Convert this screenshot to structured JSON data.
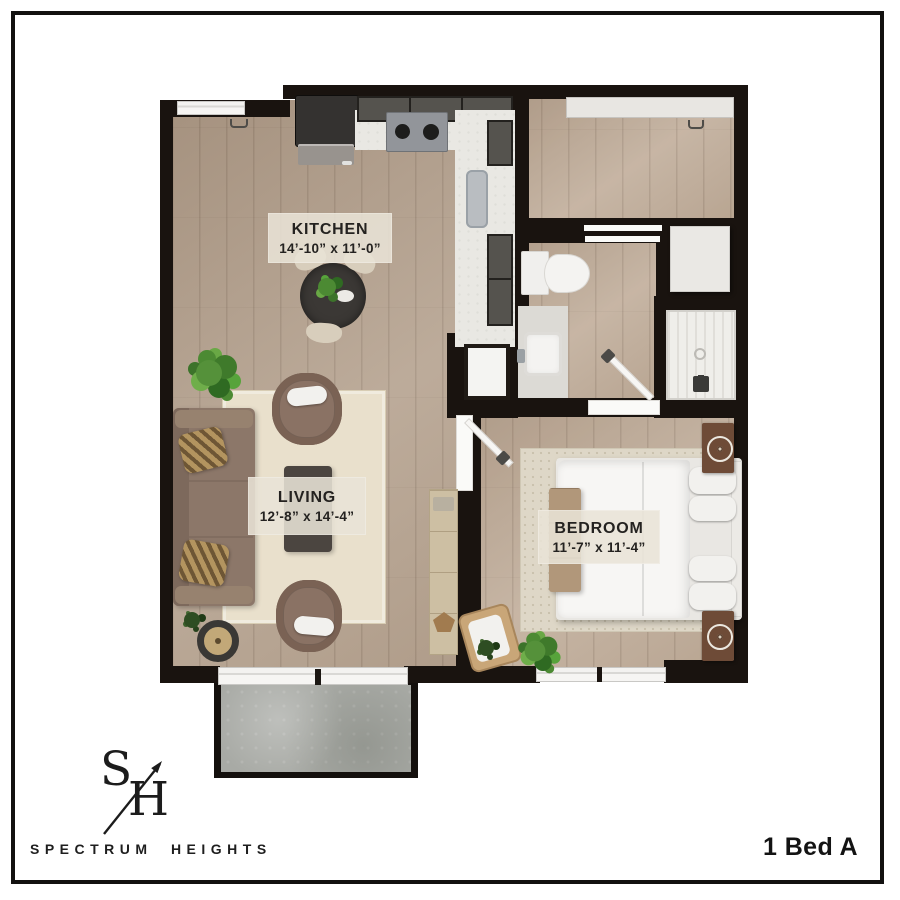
{
  "branding": {
    "monogram": {
      "letter_s": "S",
      "letter_h": "H"
    },
    "company_name": "SPECTRUM HEIGHTS"
  },
  "plan": {
    "unit_label": "1 Bed A",
    "rooms": [
      {
        "name": "KITCHEN",
        "dimensions": "14’-10” x 11’-0”"
      },
      {
        "name": "LIVING",
        "dimensions": "12’-8” x 14’-4”"
      },
      {
        "name": "BEDROOM",
        "dimensions": "11’-7” x 11’-4”"
      }
    ]
  },
  "icons": {
    "monogram_slash": "arrow-slash-icon"
  },
  "colors": {
    "wall": "#19130f",
    "wood_floor": "#b5a28f",
    "balcony_concrete": "#a8aaa5",
    "rug_living": "#e9e0cc",
    "rug_bedroom": "#ded7c7",
    "sofa": "#8c7769",
    "armchair": "#8a7264",
    "coffee_table": "#4b4540",
    "kitchen_cabinet": "#55534e",
    "counter": "#e9e8e3",
    "bedding": "#f7f6f4",
    "nightstand": "#6e4b37",
    "label_background": "#e9e2d3",
    "label_text": "#242220",
    "frame": "#121110"
  }
}
